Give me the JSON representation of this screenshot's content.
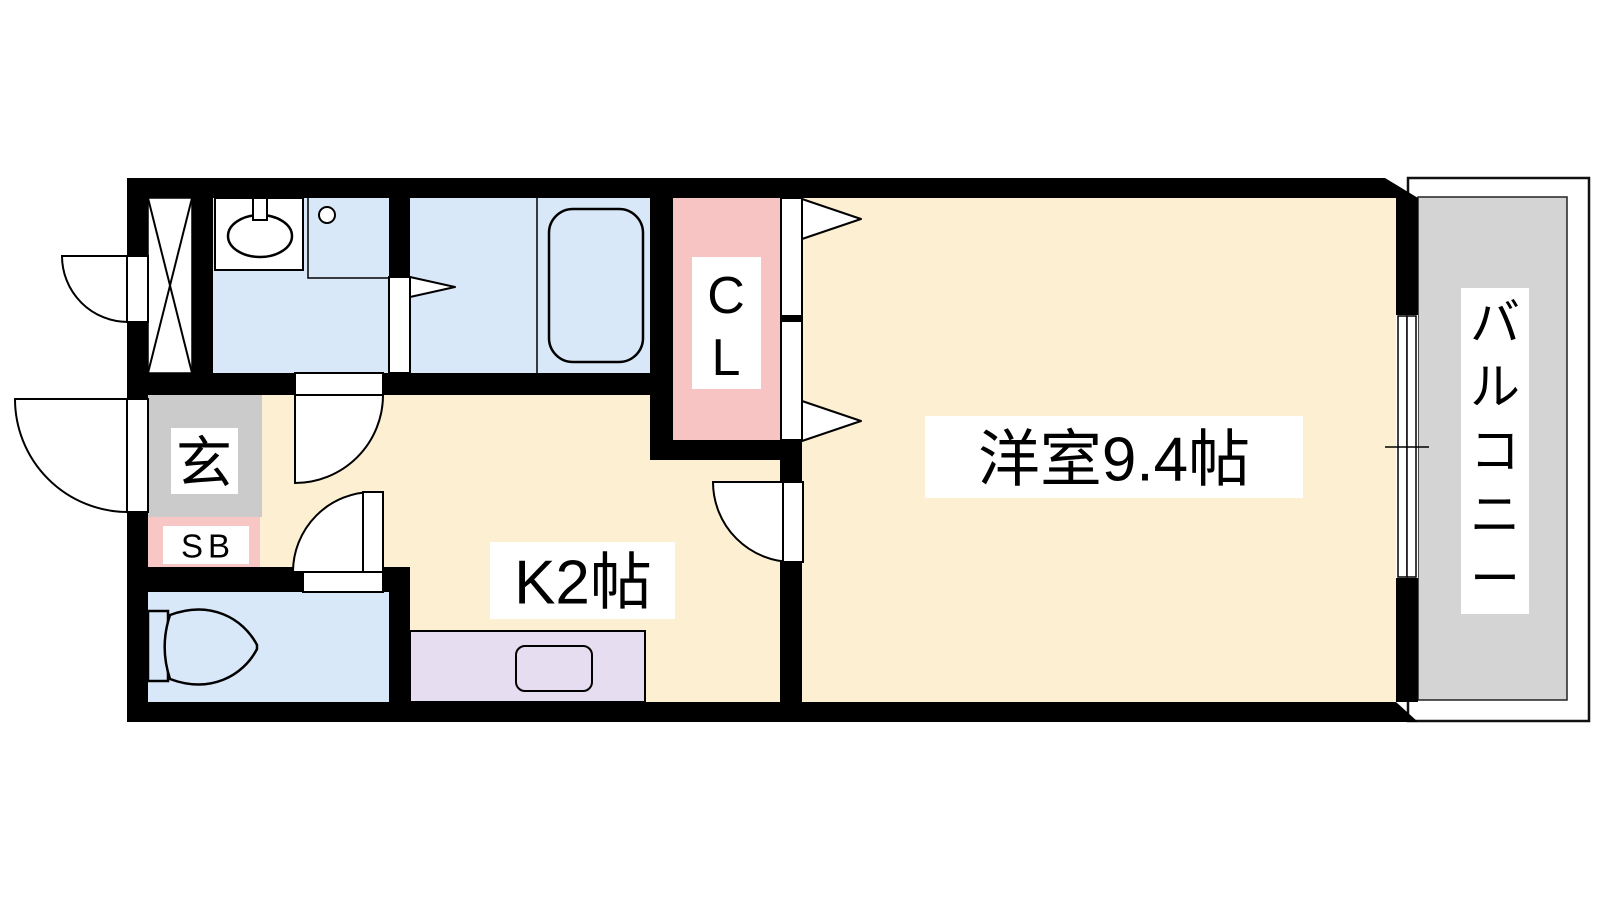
{
  "floorplan": {
    "type_note": "1K apartment floor plan",
    "rooms": {
      "western_room": {
        "label": "洋室9.4帖"
      },
      "kitchen": {
        "label": "K2帖"
      },
      "closet": {
        "label": "CL",
        "chars": [
          "C",
          "L"
        ]
      },
      "entrance": {
        "label": "玄"
      },
      "shoe_box": {
        "label": "SB"
      },
      "balcony": {
        "label": "バルコニー",
        "chars": [
          "バ",
          "ル",
          "コ",
          "ニ",
          "ー"
        ]
      }
    },
    "colors": {
      "floor_cream": "#fdf0d2",
      "wet_area_blue": "#d9e8f8",
      "closet_pink": "#f8c3c3",
      "shoebox_pink": "#f9c6c6",
      "entrance_gray": "#cbcbcb",
      "balcony_gray": "#d4d4d4",
      "counter_lavender": "#e6def0",
      "wall_black": "#000000",
      "fixture_white": "#ffffff"
    }
  }
}
